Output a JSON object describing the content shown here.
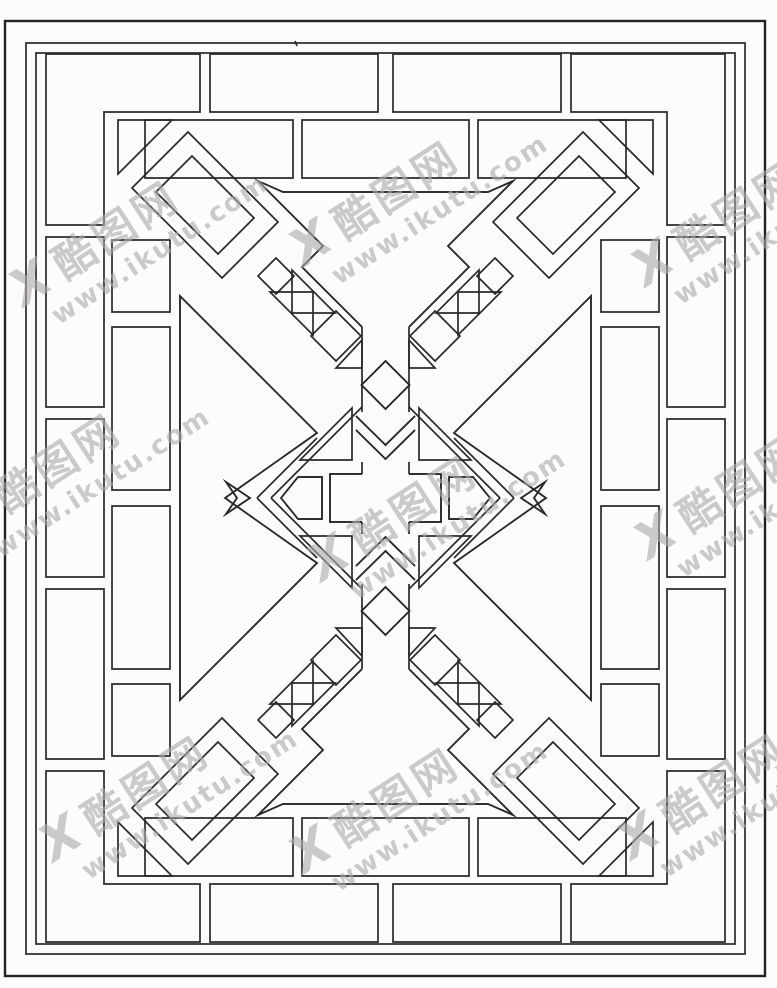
{
  "artwork": {
    "kind": "chinese-lattice-window-pattern-line-drawing",
    "description": "Black line-art of a traditional Chinese lattice window grille: double rectangular border, perimeter brick frame, four diagonal corner arrow motifs, top and bottom inward-pointing arrow motifs, left and right chevron motifs, central diamond with cross"
  },
  "colors": {
    "background": "#fcfcfb",
    "line": "#2a2a2a",
    "watermark": "#aeacaa"
  },
  "watermark": {
    "logo_mark": "X",
    "site_name": "酷图网",
    "url": "www.ikutu.com"
  }
}
